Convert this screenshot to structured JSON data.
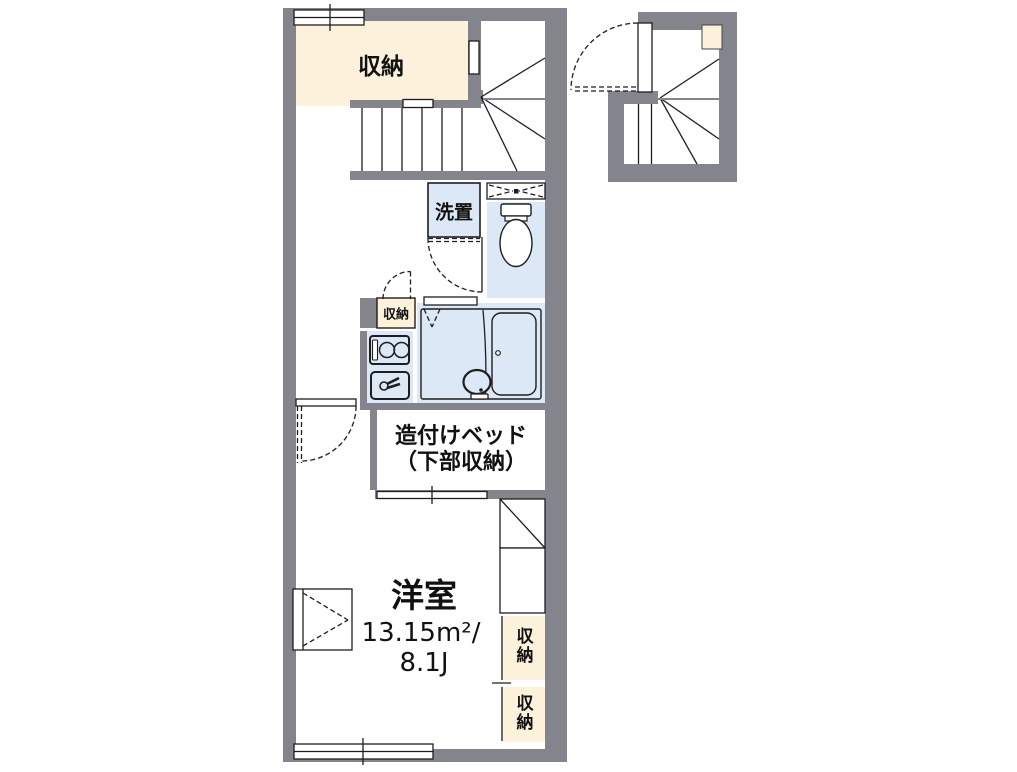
{
  "title": "apartment-floor-plan",
  "colors": {
    "wall": "#84848C",
    "storage": "#FCF2DC",
    "water": "#DCE8F6",
    "line": "#1E1E1E",
    "bg": "#FFFFFF"
  },
  "rooms": {
    "storage_top": {
      "label": "収納"
    },
    "washer": {
      "label": "洗置"
    },
    "storage_mid": {
      "label": "収納"
    },
    "bed": {
      "line1": "造付けベッド",
      "line2": "（下部収納）"
    },
    "main_room": {
      "name": "洋室",
      "area": "13.15m²/",
      "size": "8.1J"
    },
    "closet_upper": {
      "label": "収納"
    },
    "closet_lower": {
      "label": "収納"
    }
  },
  "fixtures": [
    "staircase",
    "winder-staircase",
    "entry-staircase",
    "toilet",
    "ventilation-window",
    "washer-space",
    "kitchen-stove",
    "kitchen-sink",
    "bathtub",
    "washbasin",
    "door-swing",
    "sliding-window",
    "folding-closet-door",
    "built-in-bed",
    "under-bed-storage"
  ]
}
